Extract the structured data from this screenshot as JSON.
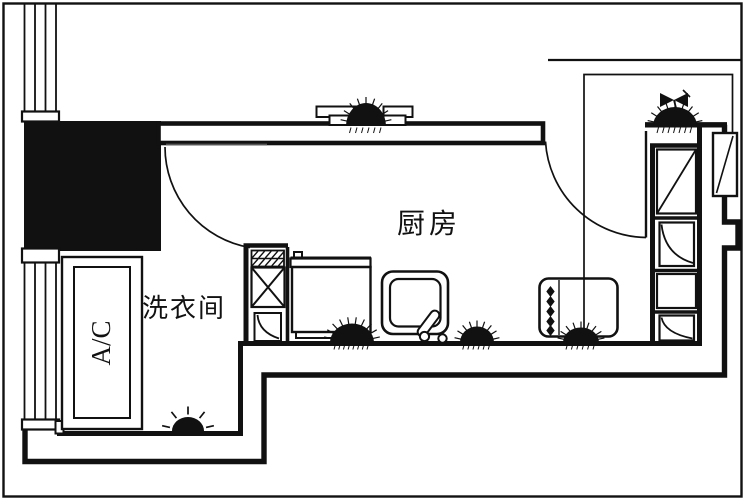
{
  "labels": {
    "kitchen": "厨房",
    "laundry": "洗衣间",
    "ac_unit": "A/C"
  },
  "colors": {
    "ink": "#111111",
    "paper": "#ffffff",
    "door_leaf": "#555555"
  }
}
